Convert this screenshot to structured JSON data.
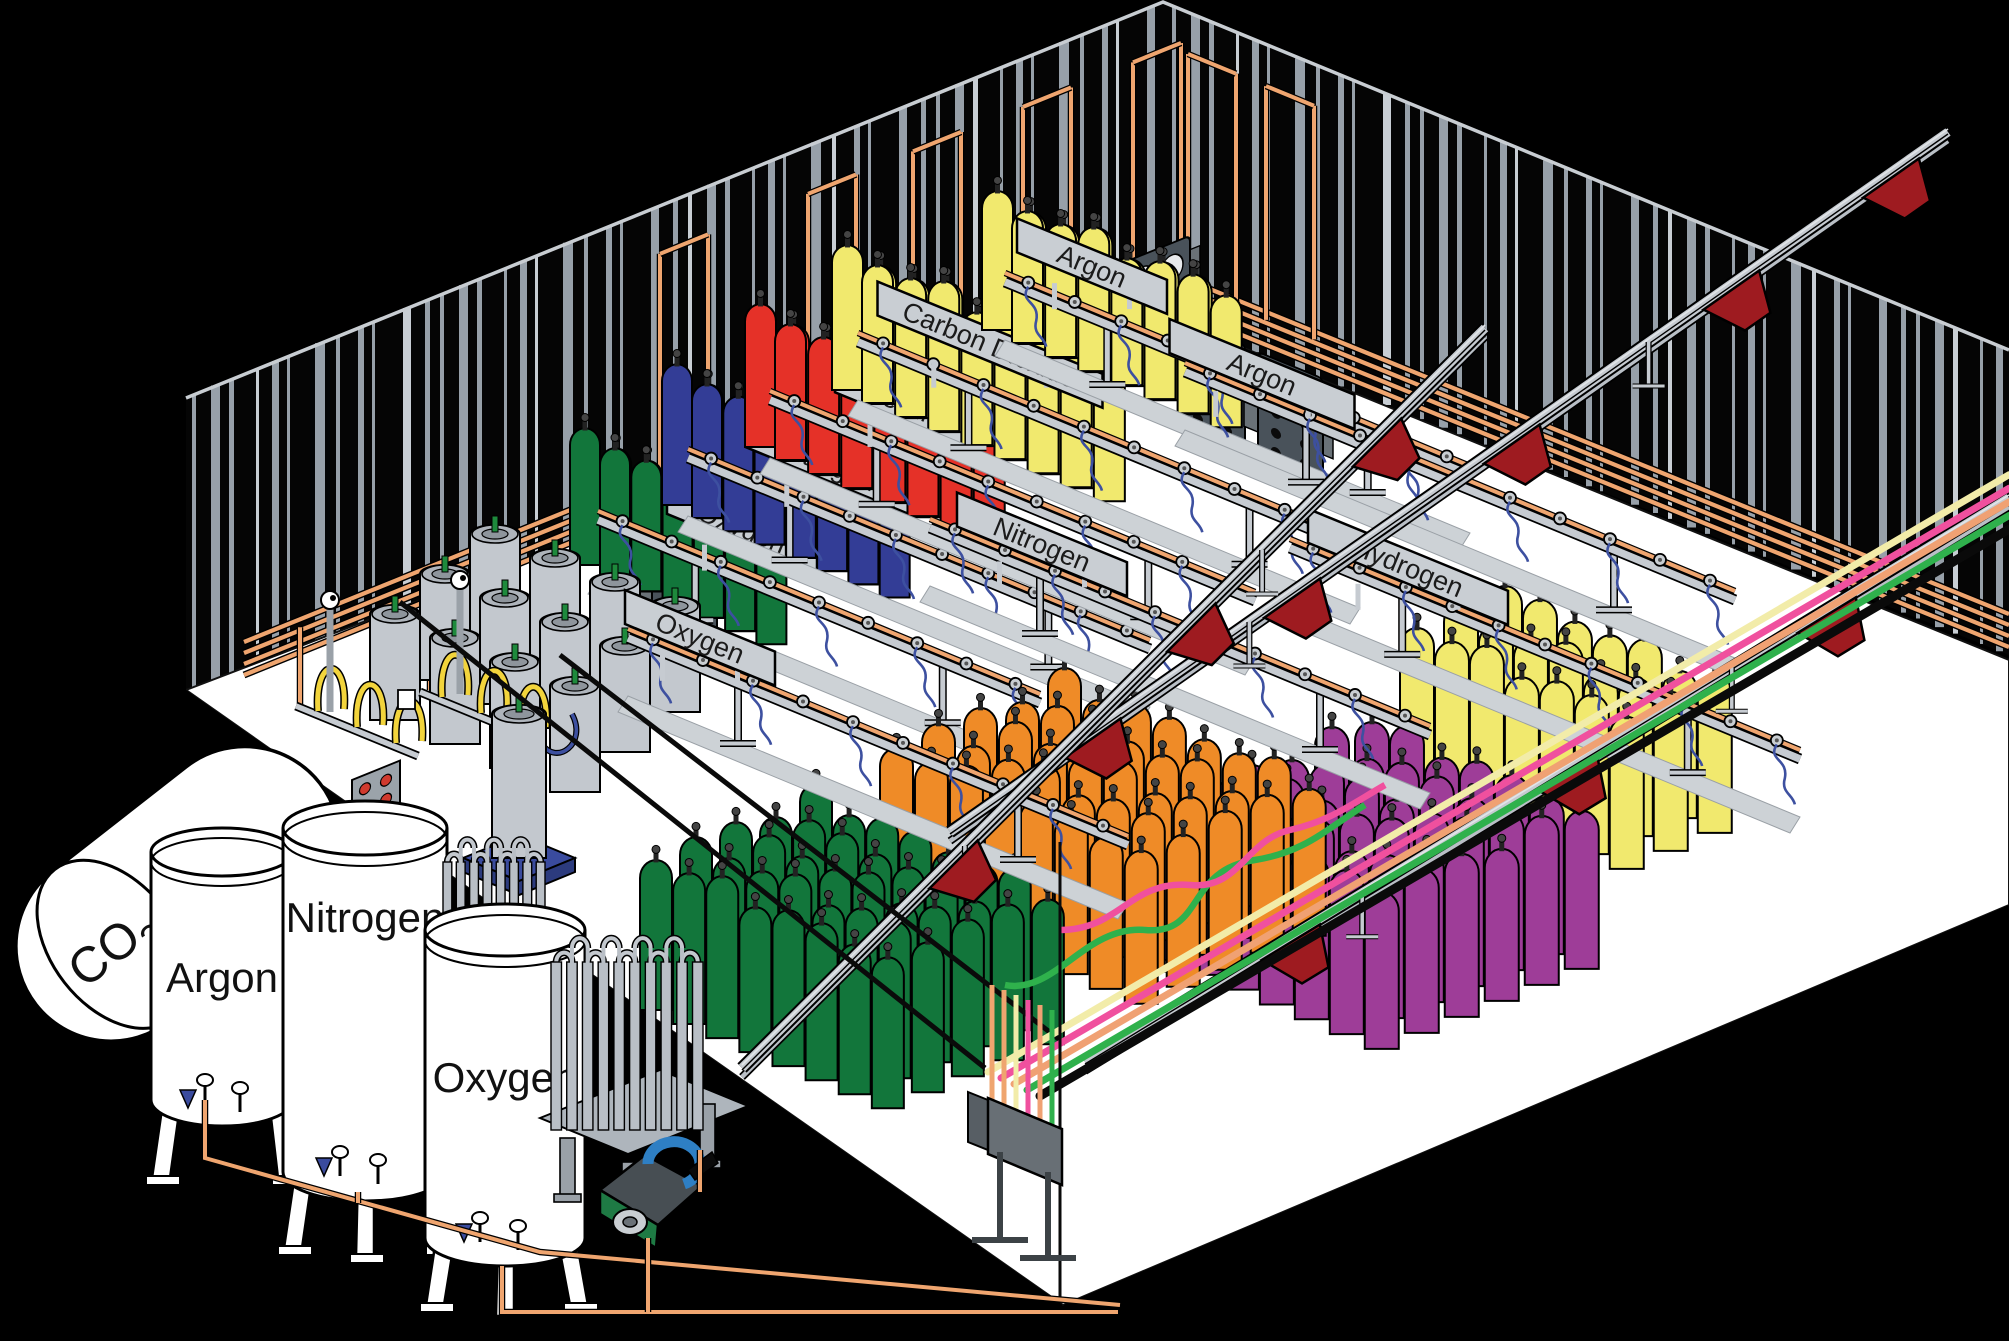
{
  "scene": {
    "background": "#000000",
    "floor": "#FFFFFF",
    "stripe": "#97A0A9",
    "stripe_light": "#C8CED4",
    "copper": "#EFA56F",
    "rail_grey": "#C6CBD1",
    "sign_bg": "#C9CED3",
    "sign_text": "#1B1B1B",
    "panel_grey": "#49525A",
    "cart_red": "#9E1B20",
    "hose_blue": "#3D50A0",
    "pigtail_yellow": "#F2D43C",
    "dewar_grey": "#C3C8CE",
    "pallet_blue": "#3A4B9E",
    "pump_green": "#1E7A44",
    "pump_pipe_blue": "#2E7FC4"
  },
  "tanks": [
    {
      "id": "co2",
      "label_main": "CO",
      "label_sub": "2"
    },
    {
      "id": "argon",
      "label": "Argon"
    },
    {
      "id": "nitrogen",
      "label": "Nitrogen"
    },
    {
      "id": "oxygen",
      "label": "Oxygen"
    }
  ],
  "stations": [
    {
      "label": "Oxygen",
      "sign_x": 742,
      "sign_w": 150,
      "sign_off": 52,
      "rail": [
        598,
        520,
        1040,
        703
      ],
      "cluster": {
        "color": "#12763B",
        "o": [
          600,
          578
        ],
        "cols": 6,
        "su": 34,
        "ranks": 2,
        "rs": [
          -30,
          -13
        ],
        "w": 30,
        "h": 128
      }
    },
    {
      "label": "Nitrogen",
      "sign_x": 828,
      "sign_w": 165,
      "sign_off": 52,
      "rail": [
        688,
        458,
        1150,
        649
      ],
      "cluster": {
        "color": "#333D96",
        "o": [
          692,
          518
        ],
        "cols": 7,
        "su": 34,
        "ranks": 2,
        "rs": [
          -30,
          -13
        ],
        "w": 30,
        "h": 132
      }
    },
    {
      "label": "Helium",
      "sign_x": 905,
      "sign_w": 140,
      "sign_off": 52,
      "rail": [
        770,
        400,
        1255,
        601
      ],
      "cluster": {
        "color": "#E53128",
        "o": [
          775,
          460
        ],
        "cols": 7,
        "su": 36,
        "ranks": 2,
        "rs": [
          -30,
          -13
        ],
        "w": 31,
        "h": 134
      }
    },
    {
      "label": "Carbon Dioxide",
      "sign_x": 990,
      "sign_w": 225,
      "sign_off": 52,
      "rail": [
        858,
        342,
        1360,
        550
      ],
      "cluster": {
        "color": "#F1E96E",
        "o": [
          862,
          403
        ],
        "cols": 8,
        "su": 36,
        "ranks": 2,
        "rs": [
          -30,
          -13
        ],
        "w": 31,
        "h": 136
      }
    },
    {
      "label": "Argon",
      "sign_x": 1092,
      "sign_w": 150,
      "sign_off": 52,
      "rail": [
        1005,
        282,
        1470,
        475
      ],
      "cluster": {
        "color": "#F1E96E",
        "o": [
          1012,
          343
        ],
        "cols": 7,
        "su": 36,
        "ranks": 2,
        "rs": [
          -30,
          -13
        ],
        "w": 31,
        "h": 130
      }
    },
    {
      "label": "Argon",
      "sign_x": 1262,
      "sign_w": 185,
      "sign_off": 30,
      "rail": [
        1185,
        372,
        1735,
        600
      ],
      "cluster": {
        "color": "#F1E96E",
        "o": [
          1400,
          780
        ],
        "cols": 7,
        "su": 38,
        "ranks": 3,
        "rs": [
          44,
          -18
        ],
        "w": 34,
        "h": 150
      }
    },
    {
      "label": "Hydrogen",
      "sign_x": 1408,
      "sign_w": 200,
      "sign_off": 30,
      "rail": [
        1290,
        548,
        1800,
        759
      ],
      "cluster": {
        "color": "#9E3D98",
        "o": [
          1155,
          960
        ],
        "cols": 7,
        "su": 38,
        "ranks": 6,
        "rs": [
          40,
          -16
        ],
        "w": 34,
        "h": 155
      }
    },
    {
      "label": "Nitrogen",
      "sign_x": 1042,
      "sign_w": 170,
      "sign_off": 30,
      "rail": [
        930,
        528,
        1430,
        735
      ],
      "cluster": {
        "color": "#EF8B27",
        "o": [
          880,
          900
        ],
        "cols": 8,
        "su": 38,
        "ranks": 5,
        "rs": [
          42,
          -17
        ],
        "w": 33,
        "h": 150
      }
    },
    {
      "label": "Oxygen",
      "sign_x": 700,
      "sign_w": 150,
      "sign_off": 30,
      "rail": [
        628,
        638,
        1128,
        845
      ],
      "cluster": {
        "color": "#12763B",
        "o": [
          640,
          1010
        ],
        "cols": 8,
        "su": 36,
        "ranks": 5,
        "rs": [
          40,
          -16
        ],
        "w": 32,
        "h": 148
      }
    }
  ],
  "flex_lines": {
    "colors": [
      "#F2ECA9",
      "#F0509E",
      "#F0A173",
      "#2FB14C",
      "#0A0A0A"
    ],
    "widths": [
      7,
      7,
      7,
      7,
      9
    ]
  },
  "dewars": {
    "cols": 4,
    "ranks": 3
  },
  "conveyors": [
    {
      "from": [
        950,
        832
      ],
      "to": [
        1948,
        132
      ],
      "carts": [
        0.14,
        0.34,
        0.56,
        0.78,
        0.94
      ]
    },
    {
      "from": [
        1085,
        1062
      ],
      "to": [
        2009,
        498
      ],
      "carts": [
        0.22,
        0.52,
        0.8
      ]
    },
    {
      "from": [
        742,
        1068
      ],
      "to": [
        1485,
        328
      ],
      "carts": [
        0.28,
        0.6,
        0.85
      ]
    }
  ],
  "wall_panels": {
    "left": [
      [
        652,
        557
      ],
      [
        800,
        468
      ],
      [
        905,
        402
      ],
      [
        1015,
        332
      ],
      [
        1125,
        262
      ]
    ],
    "right": [
      [
        1180,
        318
      ],
      [
        1258,
        352
      ]
    ]
  }
}
